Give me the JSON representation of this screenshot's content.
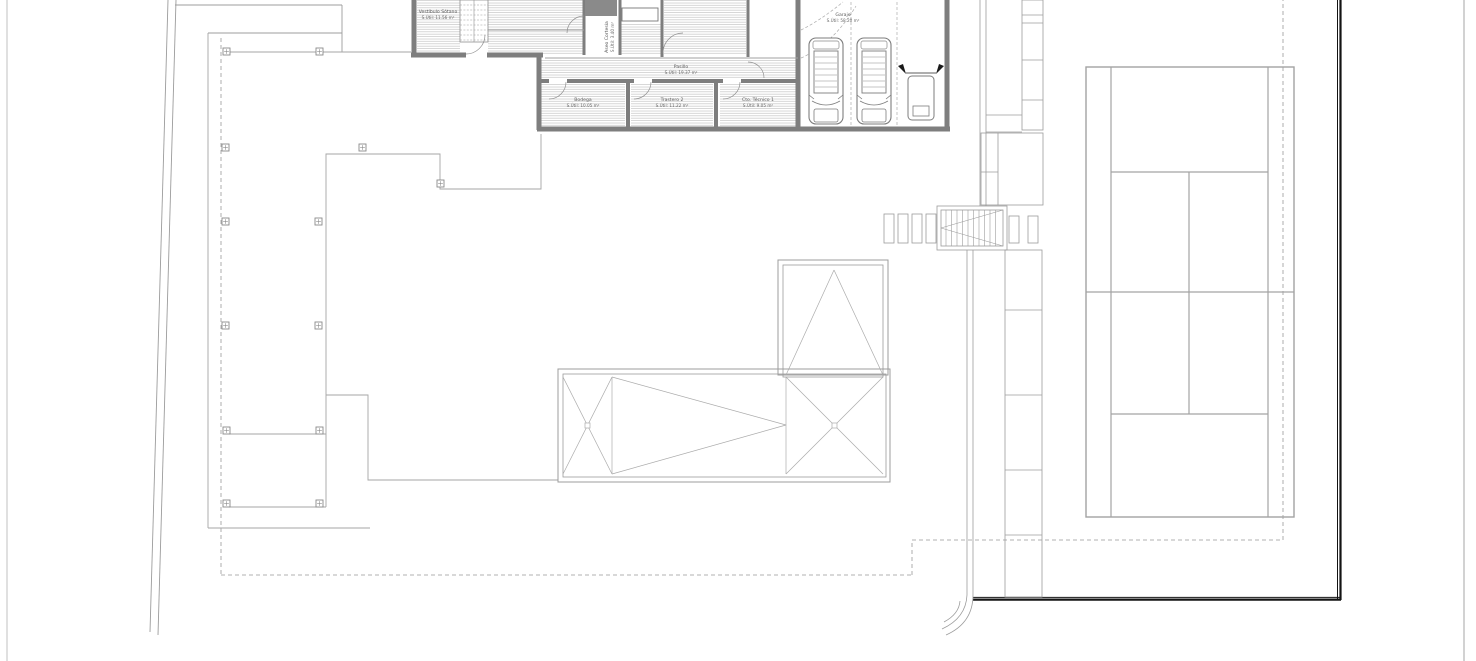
{
  "plan": {
    "type": "architectural-site-plan",
    "rooms": [
      {
        "name": "Vestíbulo Sótano",
        "area": "S.Útil: 11.56 m²"
      },
      {
        "name": "Aseo Cortesía",
        "area": "S.Útil: 3.40 m²"
      },
      {
        "name": "Pasillo",
        "area": "S.Útil: 19.37 m²"
      },
      {
        "name": "Bodega",
        "area": "S.Útil: 10.05 m²"
      },
      {
        "name": "Trastero 2",
        "area": "S.Útil: 11.22 m²"
      },
      {
        "name": "Cto. Técnico 1",
        "area": "S.Útil: 9.05 m²"
      },
      {
        "name": "Garaje",
        "area": "S.Útil: 58.20 m²"
      }
    ],
    "features": {
      "garage_cars": 2,
      "garage_motorcycles": 1,
      "tennis_court": true,
      "pergola_posts": 13,
      "exterior_stair": true
    },
    "colors": {
      "background": "#ffffff",
      "wall": "#7e7e7e",
      "hatch": "#c3c3c3",
      "thin_line": "#9c9c9c",
      "dashed_line": "#999999",
      "plot_boundary": "#141414",
      "label_text": "#5a5a5a"
    }
  }
}
